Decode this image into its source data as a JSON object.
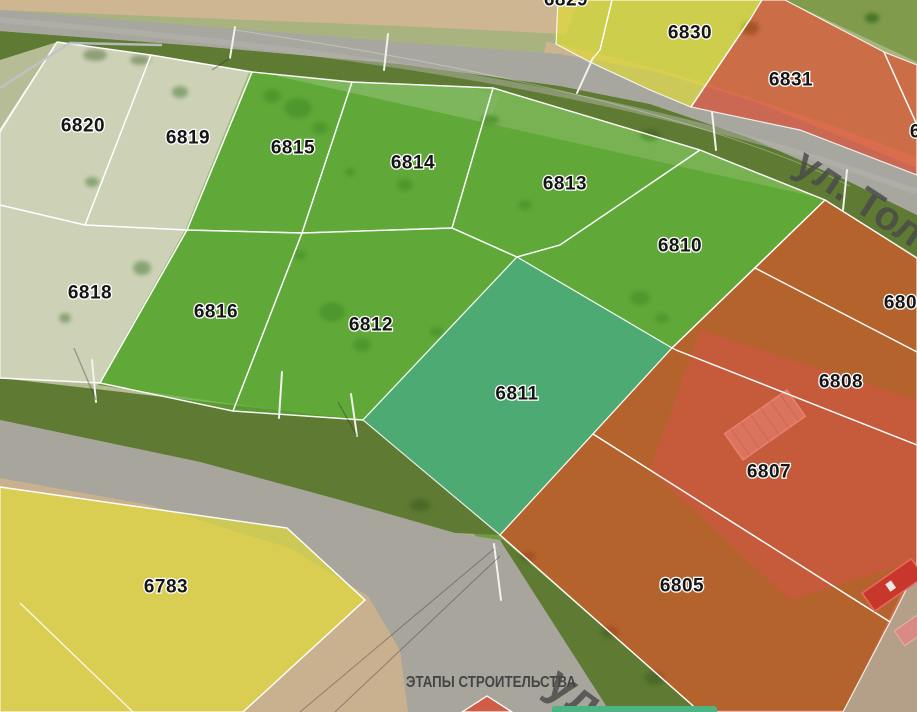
{
  "map": {
    "type": "land-plot-aerial-map",
    "status_colors": {
      "available_green": "#56b234",
      "selected_teal": "#4cab76",
      "reserved_yellow": "#e4de2c",
      "sold_red": "#e23e22",
      "inactive_pale": "#ffffff",
      "bottom_bar_green": "#4bb583"
    },
    "plots": [
      {
        "id": "6829",
        "status": "reserved"
      },
      {
        "id": "6830",
        "status": "reserved"
      },
      {
        "id": "6831",
        "status": "sold"
      },
      {
        "id": "6832",
        "status": "sold"
      },
      {
        "id": "6820",
        "status": "inactive"
      },
      {
        "id": "6819",
        "status": "inactive"
      },
      {
        "id": "6815",
        "status": "available"
      },
      {
        "id": "6814",
        "status": "available"
      },
      {
        "id": "6813",
        "status": "available"
      },
      {
        "id": "6810",
        "status": "available"
      },
      {
        "id": "6818",
        "status": "inactive"
      },
      {
        "id": "6816",
        "status": "available"
      },
      {
        "id": "6812",
        "status": "available"
      },
      {
        "id": "6811",
        "status": "selected"
      },
      {
        "id": "6809",
        "status": "sold"
      },
      {
        "id": "6808",
        "status": "sold"
      },
      {
        "id": "6807",
        "status": "sold"
      },
      {
        "id": "6805",
        "status": "sold"
      },
      {
        "id": "6783",
        "status": "reserved"
      }
    ],
    "street_labels": [
      {
        "text": "ул. Тол"
      },
      {
        "text": "ул."
      }
    ],
    "captions": {
      "construction_stages": "ЭТАПЫ СТРОИТЕЛЬСТВА"
    }
  }
}
